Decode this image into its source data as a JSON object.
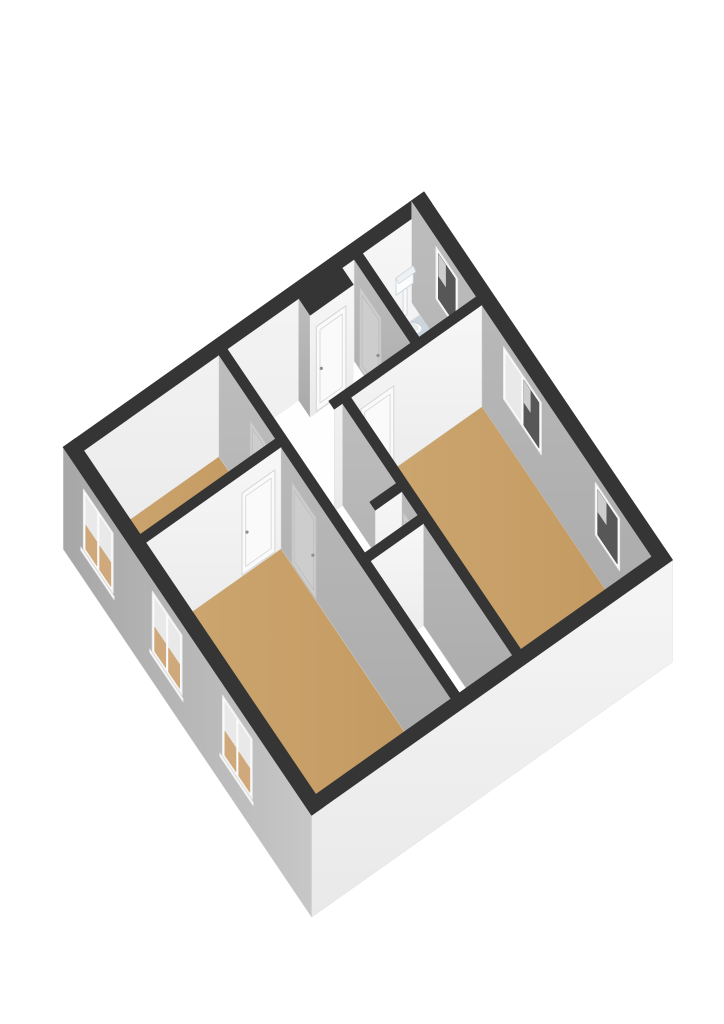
{
  "scene": {
    "type": "floor-plan-3d",
    "style": "axonometric dollhouse render",
    "background": "#ffffff"
  },
  "palette": {
    "wall_cap": "#353535",
    "face_bright_top": "#f7f7f7",
    "face_bright_bottom": "#eaeaea",
    "face_shade_top": "#bdbdbd",
    "face_shade_bottom": "#a9a9a9",
    "exterior_sw_dark": "#a7a7a7",
    "exterior_sw_light": "#c7c7c7",
    "exterior_se_top": "#f5f5f5",
    "exterior_se_bottom": "#e9e9e9",
    "floor_wood_light": "#cda771",
    "floor_wood_dark": "#c2985f",
    "floor_tile_light": "#d2dbe2",
    "floor_tile_dark": "#c6d0d9",
    "floor_white": "#fefefe",
    "window_frame": "#fbfbfb",
    "window_glass_dark": "#575757",
    "window_glass_reflect": "#e9e9e9",
    "window_glass_floor": "#cfa97b",
    "door_light": "#fafafa",
    "door_light_stroke": "#d5d5d5",
    "door_shade": "#cdcdcd",
    "door_shade_stroke": "#bcbcbc",
    "door_handle": "#8f8f8f",
    "fixture_fill": "#f6f8f9",
    "fixture_stroke": "#cdd3d8"
  },
  "building": {
    "plan_width_m": 9.2,
    "plan_depth_m": 8.8,
    "wall_height_m": 2.55,
    "exterior_wall_thickness_m": 0.3,
    "interior_wall_thickness_m": 0.2
  },
  "model": {
    "walls_far": [
      {
        "id": "wall-nw-exterior",
        "rect": [
          0,
          0,
          0.3,
          8.8
        ],
        "orient": "y"
      },
      {
        "id": "wall-ne-exterior",
        "rect": [
          0,
          0,
          9.2,
          0.3
        ],
        "orient": "x",
        "windows": [
          {
            "id": "window-ne-bathroom",
            "range": [
              0.9,
              1.7
            ],
            "z": [
              1.0,
              2.3
            ],
            "panes": 1,
            "glass": "dark"
          },
          {
            "id": "window-ne-bedroom-right-double",
            "range": [
              3.4,
              4.8
            ],
            "z": [
              1.0,
              2.3
            ],
            "panes": 2,
            "glass": "dark"
          },
          {
            "id": "window-ne-bedroom-right-single",
            "range": [
              6.8,
              7.7
            ],
            "z": [
              1.0,
              2.3
            ],
            "panes": 1,
            "glass": "dark"
          }
        ]
      }
    ],
    "floors": [
      {
        "id": "floor-bathroom",
        "surface": "tile",
        "poly": [
          [
            0.3,
            0.3
          ],
          [
            2.4,
            0.3
          ],
          [
            2.4,
            1.7
          ],
          [
            0.3,
            1.7
          ]
        ]
      },
      {
        "id": "floor-entry-hall",
        "surface": "white",
        "poly": [
          [
            0.3,
            1.9
          ],
          [
            2.4,
            1.9
          ],
          [
            2.4,
            5.0
          ],
          [
            0.3,
            5.0
          ]
        ]
      },
      {
        "id": "floor-hall-opening",
        "surface": "white",
        "poly": [
          [
            2.4,
            3.9
          ],
          [
            2.6,
            3.9
          ],
          [
            2.6,
            5.0
          ],
          [
            2.4,
            5.0
          ]
        ]
      },
      {
        "id": "floor-bedroom-right",
        "surface": "wood",
        "poly": [
          [
            2.6,
            0.3
          ],
          [
            8.9,
            0.3
          ],
          [
            8.9,
            3.5
          ],
          [
            2.6,
            3.5
          ]
        ]
      },
      {
        "id": "floor-hallway",
        "surface": "white",
        "poly": [
          [
            2.6,
            3.7
          ],
          [
            5.4,
            3.7
          ],
          [
            5.4,
            5.0
          ],
          [
            2.6,
            5.0
          ]
        ]
      },
      {
        "id": "floor-storage",
        "surface": "white",
        "poly": [
          [
            5.6,
            3.7
          ],
          [
            8.9,
            3.7
          ],
          [
            8.9,
            5.0
          ],
          [
            5.6,
            5.0
          ]
        ]
      },
      {
        "id": "floor-living-room",
        "surface": "wood",
        "poly": [
          [
            2.6,
            5.2
          ],
          [
            8.9,
            5.2
          ],
          [
            8.9,
            8.5
          ],
          [
            2.6,
            8.5
          ]
        ]
      },
      {
        "id": "floor-bedroom-left",
        "surface": "wood",
        "poly": [
          [
            0.3,
            5.2
          ],
          [
            2.4,
            5.2
          ],
          [
            2.4,
            8.5
          ],
          [
            0.3,
            8.5
          ]
        ]
      }
    ],
    "entrance_recess": {
      "id": "entrance-recess",
      "block": [
        0.3,
        2.2,
        0.72,
        3.25
      ],
      "door": {
        "id": "door-entrance",
        "range": [
          2.38,
          3.1
        ],
        "top": 2.15,
        "tone": "light"
      }
    },
    "fixtures": [
      {
        "id": "toilet",
        "type": "toilet",
        "tank": {
          "plane": 0.33,
          "y": [
            0.48,
            0.9
          ],
          "z": [
            0.95,
            1.38
          ]
        },
        "pipe": {
          "plane": 0.33,
          "y": [
            0.63,
            0.73
          ],
          "z": [
            0.28,
            0.95
          ]
        },
        "bowl": {
          "x": 0.62,
          "y": 0.7,
          "z": 0.26,
          "rx": 10,
          "ry": 6
        }
      }
    ],
    "walls_interior": [
      {
        "id": "wall-bathroom-south",
        "rect": [
          0.3,
          1.7,
          2.4,
          1.9
        ],
        "orient": "x",
        "doors": [
          {
            "id": "door-bathroom",
            "range": [
              0.5,
              1.3
            ],
            "top": 2.08,
            "tone": "shade"
          }
        ]
      },
      {
        "id": "wall-hall-east",
        "rect": [
          2.4,
          0.3,
          2.6,
          3.9
        ],
        "orient": "y",
        "doors": [
          {
            "id": "door-bedroom-right-hall",
            "range": [
              2.45,
              3.25
            ],
            "top": 2.08,
            "tone": "light"
          }
        ]
      },
      {
        "id": "wall-bedroom-right-south",
        "rect": [
          2.6,
          3.5,
          8.9,
          3.7
        ],
        "orient": "x",
        "doors": [
          {
            "id": "door-bedroom-right",
            "range": [
              4.85,
              5.35
            ],
            "top": 2.08,
            "tone": "shade"
          }
        ]
      },
      {
        "id": "wall-nook-stub",
        "rect": [
          4.6,
          3.7,
          4.8,
          4.35
        ],
        "orient": "y"
      },
      {
        "id": "wall-hallway-east",
        "rect": [
          5.4,
          3.7,
          5.6,
          5.0
        ],
        "orient": "y"
      },
      {
        "id": "wall-living-north",
        "rect": [
          0.3,
          5.0,
          8.9,
          5.2
        ],
        "orient": "x",
        "doors": [
          {
            "id": "door-bedroom-left-hall",
            "range": [
              1.45,
              2.05
            ],
            "top": 2.08,
            "tone": "shade"
          },
          {
            "id": "door-living-room",
            "range": [
              3.0,
              3.9
            ],
            "top": 2.08,
            "tone": "shade"
          }
        ]
      },
      {
        "id": "wall-bedrooms-divider",
        "rect": [
          2.4,
          5.2,
          2.6,
          8.5
        ],
        "orient": "y",
        "doors": [
          {
            "id": "door-bedroom-left",
            "range": [
              5.35,
              6.15
            ],
            "top": 2.08,
            "tone": "light"
          }
        ]
      }
    ],
    "walls_near": [
      {
        "id": "wall-se-exterior",
        "rect": [
          8.9,
          0,
          9.2,
          8.8
        ],
        "orient": "y",
        "exterior": "se"
      },
      {
        "id": "wall-sw-exterior",
        "rect": [
          0,
          8.5,
          9.2,
          8.8
        ],
        "orient": "x",
        "exterior": "sw",
        "windows": [
          {
            "id": "window-sw-bedroom-left",
            "range": [
              0.75,
              1.85
            ],
            "z": [
              0.75,
              2.25
            ],
            "panes": 2,
            "glass": "interior"
          },
          {
            "id": "window-sw-living-1",
            "range": [
              3.3,
              4.4
            ],
            "z": [
              0.75,
              2.25
            ],
            "panes": 2,
            "glass": "interior"
          },
          {
            "id": "window-sw-living-2",
            "range": [
              5.9,
              7.0
            ],
            "z": [
              0.75,
              2.25
            ],
            "panes": 2,
            "glass": "interior"
          }
        ]
      }
    ]
  }
}
